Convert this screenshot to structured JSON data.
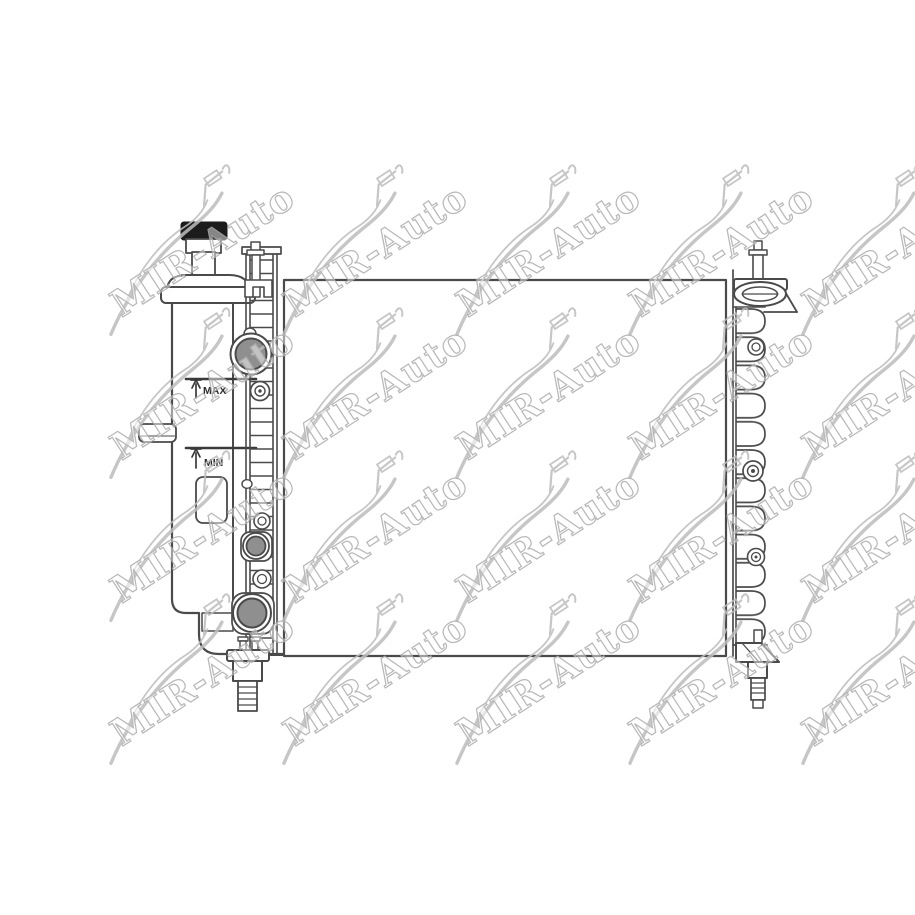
{
  "image": {
    "description": "Technical line drawing of an automotive radiator with side expansion tank, filler neck, hose ports and drain plugs",
    "background_color": "#ffffff",
    "line_color": "#4a4a4a",
    "port_fill_color": "#8f8f8f",
    "cap_fill_color": "#1c1c1c"
  },
  "labels": {
    "max": "MAX",
    "min": "MIN"
  },
  "watermark": {
    "text": "MIR-Auto",
    "icon": "car-silhouette-icon",
    "color": "#adadad",
    "soft_color": "#bdbdbd",
    "rotation_deg": -33,
    "grid": {
      "rows": 4,
      "cols": 5
    }
  }
}
